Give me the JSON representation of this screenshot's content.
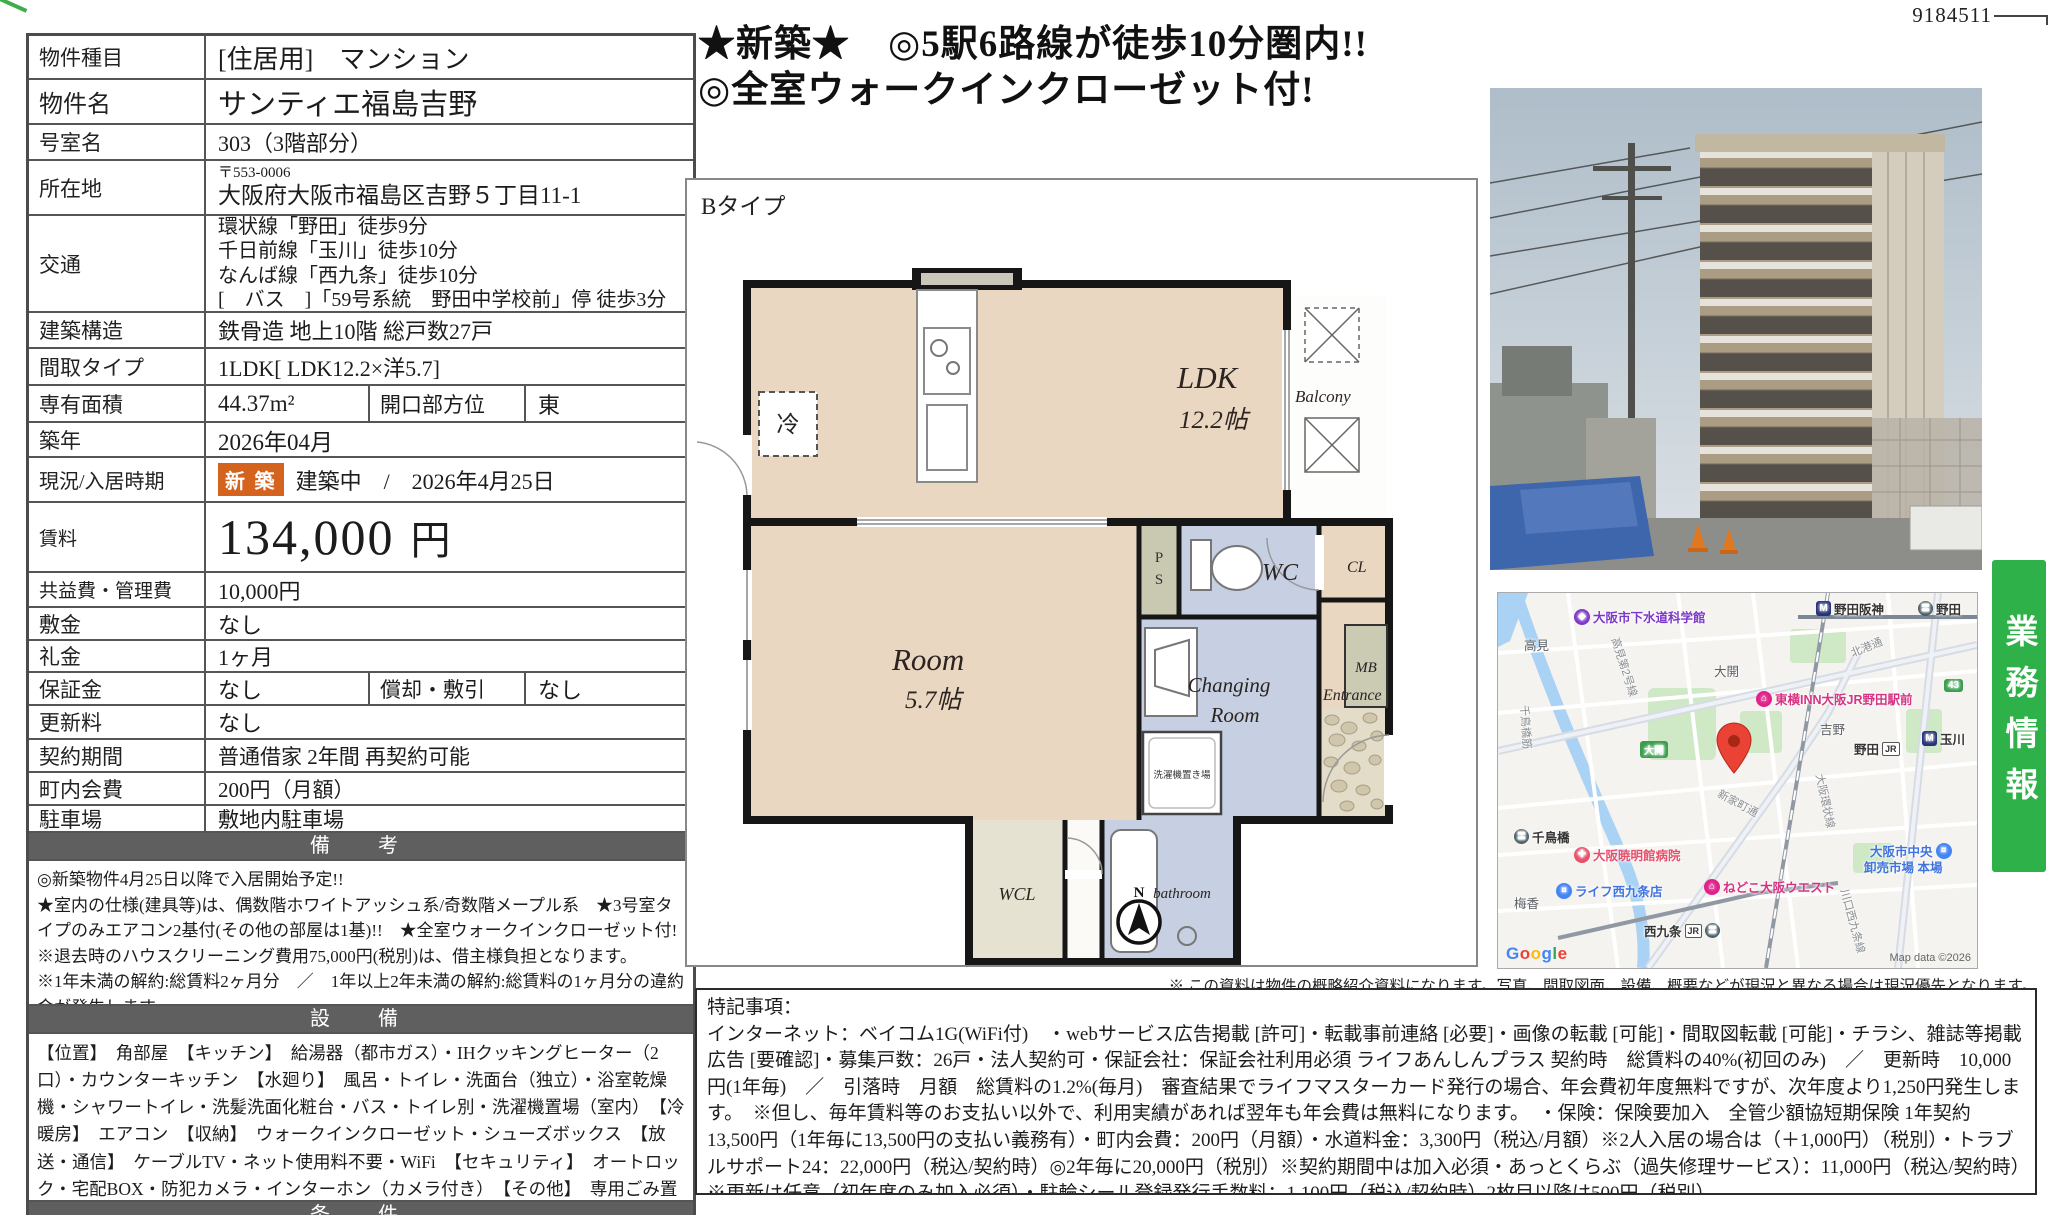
{
  "doc_number": "9184511",
  "headline": {
    "line1": "★新築★　◎5駅6路線が徒歩10分圏内!!",
    "line2": "◎全室ウォークインクローゼット付!"
  },
  "table": {
    "property_type": {
      "label": "物件種目",
      "value": "[住居用]　マンション"
    },
    "property_name": {
      "label": "物件名",
      "value": "サンティエ福島吉野"
    },
    "room_no": {
      "label": "号室名",
      "value": "303（3階部分）"
    },
    "address": {
      "label": "所在地",
      "postal": "〒553-0006",
      "value": "大阪府大阪市福島区吉野５丁目11-1"
    },
    "access": {
      "label": "交通",
      "lines": [
        "環状線「野田」徒歩9分",
        "千日前線「玉川」徒歩10分",
        "なんば線「西九条」徒歩10分",
        "[　バス　]「59号系統　野田中学校前」停 徒歩3分"
      ]
    },
    "structure": {
      "label": "建築構造",
      "value": "鉄骨造 地上10階 総戸数27戸"
    },
    "layout": {
      "label": "間取タイプ",
      "value": "1LDK[ LDK12.2×洋5.7]"
    },
    "area": {
      "label": "専有面積",
      "value": "44.37m²",
      "label2": "開口部方位",
      "value2": "東"
    },
    "built": {
      "label": "築年",
      "value": "2026年04月"
    },
    "status": {
      "label": "現況/入居時期",
      "badge": "新 築",
      "value": "建築中　/　2026年4月25日"
    },
    "rent": {
      "label": "賃料",
      "value": "134,000",
      "unit": "円"
    },
    "common_fee": {
      "label": "共益費・管理費",
      "value": "10,000円"
    },
    "deposit": {
      "label": "敷金",
      "value": "なし"
    },
    "key_money": {
      "label": "礼金",
      "value": "1ヶ月"
    },
    "guarantee": {
      "label": "保証金",
      "value": "なし",
      "label2": "償却・敷引",
      "value2": "なし"
    },
    "renewal_fee": {
      "label": "更新料",
      "value": "なし"
    },
    "contract": {
      "label": "契約期間",
      "value": "普通借家 2年間 再契約可能"
    },
    "town_fee": {
      "label": "町内会費",
      "value": "200円（月額）"
    },
    "parking": {
      "label": "駐車場",
      "value": "敷地内駐車場"
    },
    "remarks": {
      "header": "備　考",
      "lines": [
        "◎新築物件4月25日以降で入居開始予定!!",
        "★室内の仕様(建具等)は、偶数階ホワイトアッシュ系/奇数階メープル系　★3号室タイプのみエアコン2基付(その他の部屋は1基)!!　★全室ウォークインクローゼット付!",
        "※退去時のハウスクリーニング費用75,000円(税別)は、借主様負担となります。",
        "※1年未満の解約:総賃料2ヶ月分　／　1年以上2年未満の解約:総賃料の1ヶ月分の違約金が発生します。"
      ]
    },
    "facilities": {
      "header": "設　備",
      "text": "【位置】　角部屋　【キッチン】　給湯器（都市ガス）・IHクッキングヒーター（2口）・カウンターキッチン　【水廻り】　風呂・トイレ・洗面台（独立）・浴室乾燥機・シャワートイレ・洗髪洗面化粧台・バス・トイレ別・洗濯機置場（室内）　【冷暖房】　エアコン　【収納】　ウォークインクローゼット・シューズボックス　【放送・通信】　ケーブルTV・ネット使用料不要・WiFi　【セキュリティ】　オートロック・宅配BOX・防犯カメラ・インターホン（カメラ付き）　【その他】　専用ごみ置場・エレベーター（1基）・自転車置場・ガス（都市ガス）・バルコニー／ベランダ・フローリング・日当たり良好"
    },
    "conditions": {
      "header": "条　件"
    }
  },
  "plan": {
    "type_label": "Bタイプ",
    "ldk": "LDK",
    "ldk_size": "12.2帖",
    "room": "Room",
    "room_size": "5.7帖",
    "wc": "WC",
    "changing1": "Changing",
    "changing2": "Room",
    "balcony": "Balcony",
    "entrance": "Entrance",
    "wcl": "WCL",
    "bathroom": "bathroom",
    "cl": "CL",
    "mb": "MB",
    "ps1": "P",
    "ps2": "S",
    "fridge": "冷",
    "laundry": "洗濯機置き場",
    "compass": "N"
  },
  "disclaimer": "※ この資料は物件の概略紹介資料になります。写真、間取図面、設備、概要などが現況と異なる場合は現況優先となります。",
  "special": {
    "title": "特記事項：",
    "body": "インターネット：ベイコム1G(WiFi付)　・webサービス広告掲載 [許可]・転載事前連絡 [必要]・画像の転載 [可能]・間取図転載 [可能]・チラシ、雑誌等掲載広告 [要確認]・募集戸数：26戸・法人契約可・保証会社：保証会社利用必須 ライフあんしんプラス 契約時　総賃料の40%(初回のみ)　／　更新時　10,000円(1年毎)　／　引落時　月額　総賃料の1.2%(毎月)　審査結果でライフマスターカード発行の場合、年会費初年度無料ですが、次年度より1,250円発生します。　※但し、毎年賃料等のお支払い以外で、利用実績があれば翌年も年会費は無料になります。　・保険：保険要加入　全管少額協短期保険 1年契約 13,500円（1年毎に13,500円の支払い義務有）・町内会費：200円（月額）・水道料金：3,300円（税込/月額）※2人入居の場合は（＋1,000円）（税別）・トラブルサポート24：22,000円（税込/契約時）◎2年毎に20,000円（税別）※契約期間中は加入必須・あっとくらぶ（過失修理サービス）：11,000円（税込/契約時）※更新は任意（初年度のみ加入必須）・駐輪シール登録発行手数料：1,100円（税込/契約時）2枚目以降は500円（税別）",
    "footer": "★新築物件　◎内見可能(2階3階のみ)　※内覧可能日、入居開始予定日は建築スケジュールの進行具合により変更になる可能性がございます。"
  },
  "banner": "業務情報",
  "map": {
    "museum": "大阪市下水道科学館",
    "nodahanshin": "野田阪神",
    "noda_top": "野田",
    "takami": "高見",
    "takami_line": "高見第2号線",
    "ohiraki": "大開",
    "ohiraki_badge": "大開",
    "hokko": "北港通",
    "toyoko": "東横INN大阪JR野田駅前",
    "yoshino": "吉野",
    "noda_jr": "野田",
    "jr": "JR",
    "tamagawa": "玉川",
    "kanjo": "大阪環状線",
    "chidoribashisuji": "千鳥橋筋",
    "shinke": "新家町通",
    "chidoribashi": "千鳥橋",
    "hospital": "大阪暁明館病院",
    "life": "ライフ西九条店",
    "nedoko": "ねどこ大阪ウエスト",
    "nishikujo": "西九条",
    "baika": "梅香",
    "ichiba1": "大阪市中央",
    "ichiba2": "卸売市場 本場",
    "kawaguchi": "川口西九条線",
    "badge_43": "43",
    "google_letters": [
      "G",
      "o",
      "o",
      "g",
      "l",
      "e"
    ],
    "credit": "Map data ©2026"
  }
}
